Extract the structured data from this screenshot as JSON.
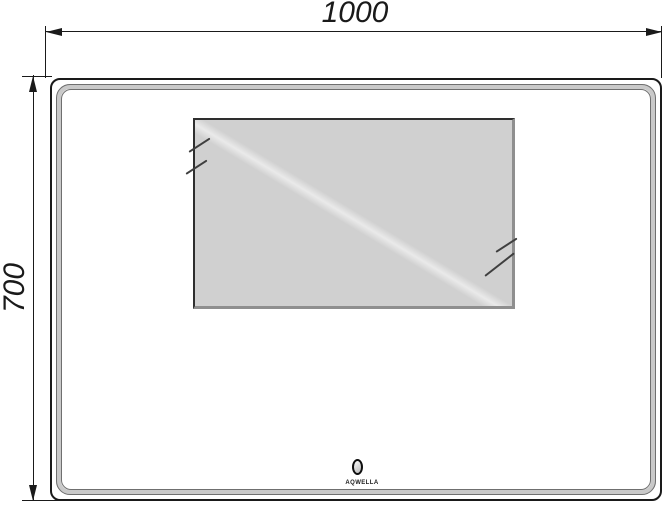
{
  "dimensions": {
    "width_label": "1000",
    "height_label": "700"
  },
  "mirror": {
    "brand_label": "AQWELLA"
  },
  "icons": {
    "screen": "tv-screen-panel",
    "glare": "glass-glare-marks",
    "sensor": "touch-sensor-oval",
    "arrows": "dimension-arrowheads"
  },
  "colors": {
    "line": "#1a1a1a",
    "band_fill": "#c9c9c9",
    "band_edge": "#6f6f6f",
    "screen_fill": "#d0d0d0",
    "screen_shadow": "#8f8f8f",
    "screen_edge": "#2e2e2e",
    "stroke": "#3f3f3f",
    "bg": "#ffffff"
  }
}
